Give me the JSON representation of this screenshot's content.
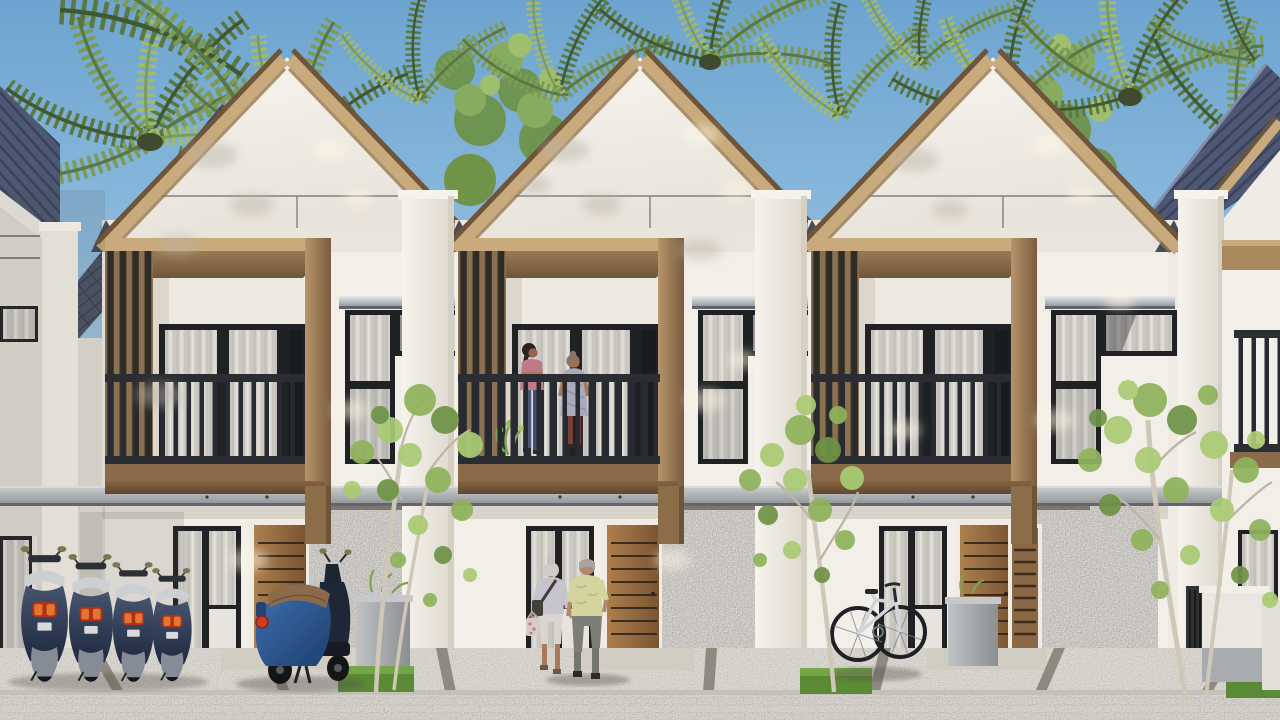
{
  "scene": {
    "type": "architectural-exterior-render",
    "description": "Daytime 3D architectural rendering of a row of modern tropical two-storey townhouses with white steep gable facades trimmed in light wood, timber-framed balconies with dark slatted railings, stone-clad ground floor accents, palm trees behind the roofline, young trees along the paved front lane, four small scooters and one large blue scooter parked at the left unit, a bicycle at the right unit, two women chatting on the centre balcony, and an elderly couple walking hand in hand toward the centre entrance.",
    "objects": [
      "sky",
      "palm-trees",
      "background-roofs",
      "townhouse-unit-1",
      "townhouse-unit-2",
      "townhouse-unit-3",
      "partial-unit-left",
      "partial-unit-right",
      "party-wall-pilasters",
      "concrete-canopy",
      "gravel-forecourt",
      "paved-road",
      "grass-planting-squares",
      "concrete-planters",
      "scooter-row",
      "large-scooter",
      "bicycle",
      "walking-couple",
      "balcony-people",
      "front-trees"
    ],
    "counts": {
      "full_townhouses": 3,
      "partial_townhouses": 2,
      "small_scooters": 4,
      "large_scooters": 1,
      "bicycles": 1,
      "people_on_balcony": 2,
      "people_walking": 2,
      "foreground_trees": 3
    },
    "time_of_day": "sunny daytime",
    "style": "modern tropical minimalist"
  },
  "palette": {
    "sky": "#72a8d1",
    "skyLow": "#a9cbe4",
    "wallWhite": "#f2efe9",
    "wallDim": "#e6e1d8",
    "wallShade": "#d9d3c9",
    "woodLight": "#c9aa7c",
    "woodMid": "#a8885c",
    "woodDark": "#6e5539",
    "slatBg": "#2f2b27",
    "frameDark": "#1f2125",
    "glassDark": "#191c1f",
    "curtain": "#d6d3cd",
    "rail": "#2a2d32",
    "roofBlue": "#4e5874",
    "tileRoof": "#4a5163",
    "stone": "#908d87",
    "gravel": "#b4afa6",
    "road": "#a3a098",
    "canopy": "#9b9ea0",
    "grass": "#5a8a35",
    "leafMid": "#7d9b58",
    "leafDark": "#5a7843",
    "leafLight": "#a3ba6b",
    "treeLeaf": "#8fb35c",
    "treeLit": "#aacb74",
    "treeDark": "#6f9347",
    "trunkLight": "#cfc7b8",
    "palmTrunk": "#6e5137",
    "scooterNavy": "#242f48",
    "seatWhite": "#ccd0d3",
    "tailRed": "#d23c22",
    "mirrorOlive": "#77794f",
    "bigBlue": "#2d5d9a",
    "bigSeat": "#8a6a4b",
    "skin": "#b08a6b"
  }
}
